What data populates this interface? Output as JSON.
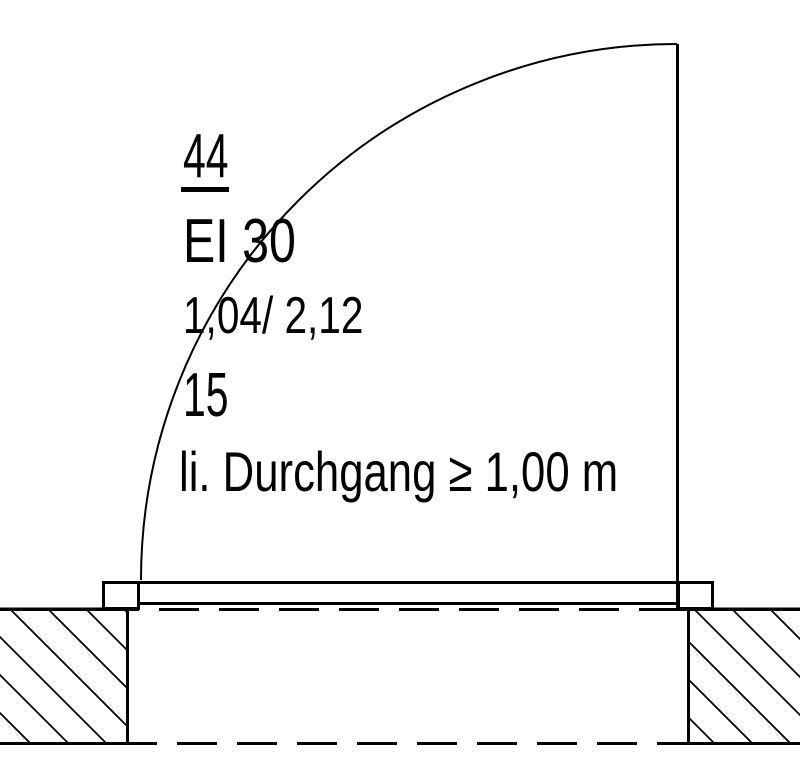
{
  "annotation": {
    "door_number": "44",
    "fire_rating": "EI 30",
    "size_width_height": "1,04/ 2,12",
    "sill_value": "15",
    "clearance_note": "li. Durchgang ≥ 1,00 m"
  },
  "drawing": {
    "line_color": "#000000",
    "background_color": "#ffffff",
    "elements": {
      "swing_arc": "door-swing-arc",
      "leaf": "door-leaf-open-90",
      "frames": [
        "door-frame-left",
        "door-frame-right"
      ],
      "walls": [
        "wall-left-hatched",
        "wall-right-hatched"
      ],
      "hidden_lines": [
        "wall-opening-dashed-top",
        "wall-dashed-bottom"
      ]
    }
  }
}
